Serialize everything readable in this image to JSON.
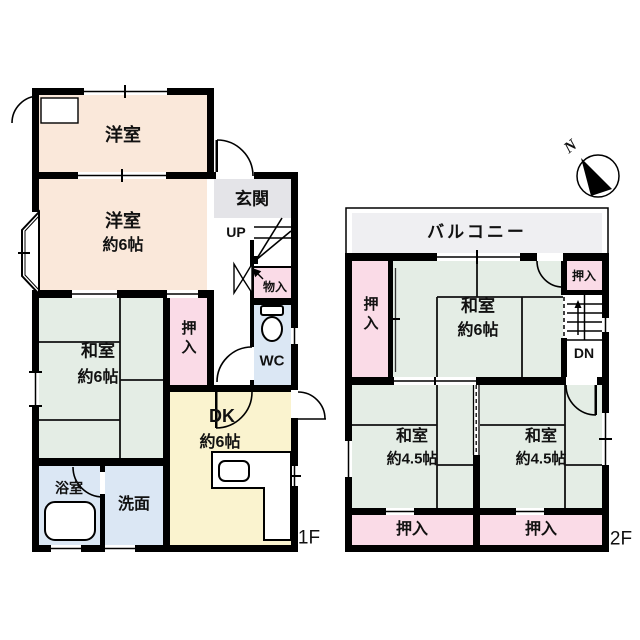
{
  "title": "house-floor-plan",
  "floors": {
    "f1": {
      "label": "1F",
      "rooms": {
        "yoshitsu_north": {
          "name": "洋室"
        },
        "yoshitsu_south": {
          "name": "洋室",
          "size": "約6帖"
        },
        "genkan": {
          "name": "玄関"
        },
        "stairs_up": {
          "label": "UP"
        },
        "monoire": {
          "name": "物入"
        },
        "oshiire": {
          "name": "押入"
        },
        "wc": {
          "name": "WC"
        },
        "washitsu": {
          "name": "和室",
          "size": "約6帖"
        },
        "dk": {
          "name": "DK",
          "size": "約6帖"
        },
        "yokushitsu": {
          "name": "浴室"
        },
        "senmen": {
          "name": "洗面"
        }
      }
    },
    "f2": {
      "label": "2F",
      "rooms": {
        "balcony": {
          "name": "バルコニー"
        },
        "oshiire_west": {
          "name": "押入"
        },
        "washitsu6": {
          "name": "和室",
          "size": "約6帖"
        },
        "oshiire_northeast": {
          "name": "押入"
        },
        "stairs_dn": {
          "label": "DN"
        },
        "washitsu45_west": {
          "name": "和室",
          "size": "約4.5帖"
        },
        "washitsu45_east": {
          "name": "和室",
          "size": "約4.5帖"
        },
        "oshiire_southwest": {
          "name": "押入"
        },
        "oshiire_southeast": {
          "name": "押入"
        }
      }
    }
  },
  "compass": {
    "north": "N"
  },
  "colors": {
    "wall": "#000000",
    "western_room": "#fae8da",
    "tatami_room": "#e4ede5",
    "closet": "#fadbe7",
    "dining_kitchen": "#faf3cf",
    "wet_area": "#dbe7f4",
    "entrance": "#e4e4e8",
    "balcony": "#efeff2"
  }
}
